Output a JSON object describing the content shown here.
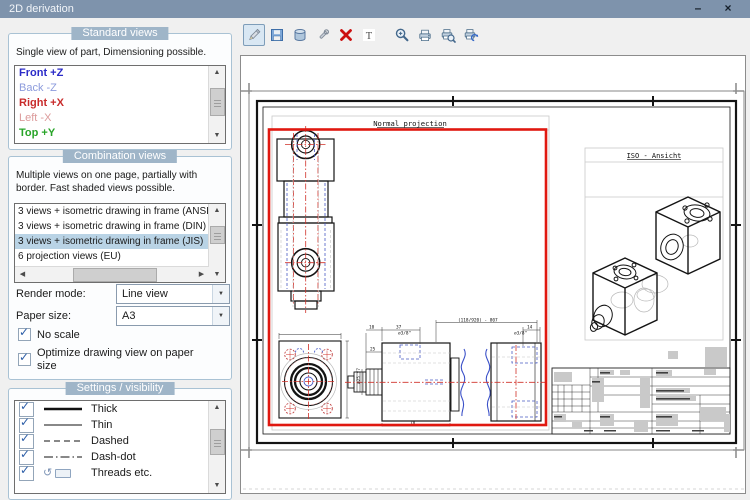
{
  "window": {
    "title": "2D derivation"
  },
  "icons": {
    "minimize": "–",
    "close": "×",
    "dropdown": "▼",
    "scroll_up": "▲",
    "scroll_down": "▼",
    "scroll_left": "◀",
    "scroll_right": "▶",
    "check": "✓",
    "threads_arrow": "↺",
    "text_tool_glyph": "T"
  },
  "toolbar": {
    "buttons": [
      {
        "id": "edit",
        "icon": "pencil-icon",
        "active": true
      },
      {
        "id": "save",
        "icon": "save-icon",
        "active": false
      },
      {
        "id": "database",
        "icon": "database-icon",
        "active": false
      },
      {
        "id": "modify",
        "icon": "wrench-icon",
        "active": false
      },
      {
        "id": "delete",
        "icon": "delete-x-icon",
        "active": false
      },
      {
        "id": "text",
        "icon": "text-icon",
        "active": false
      },
      {
        "id": "zoom",
        "icon": "magnifier-icon",
        "active": false
      },
      {
        "id": "print",
        "icon": "printer-icon",
        "active": false
      },
      {
        "id": "print-preview",
        "icon": "printer-preview-icon",
        "active": false
      },
      {
        "id": "print-setup",
        "icon": "printer-setup-icon",
        "active": false
      }
    ]
  },
  "standard_views": {
    "header": "Standard views",
    "description": "Single view of part, Dimensioning possible.",
    "items": [
      {
        "label": "Front +Z",
        "color": "#2B2BC8",
        "bold": true
      },
      {
        "label": "Back -Z",
        "color": "#8C9BDC",
        "bold": false
      },
      {
        "label": "Right +X",
        "color": "#C82B2B",
        "bold": true
      },
      {
        "label": "Left -X",
        "color": "#DC9B9B",
        "bold": false
      },
      {
        "label": "Top +Y",
        "color": "#28A428",
        "bold": true
      }
    ]
  },
  "combination_views": {
    "header": "Combination views",
    "description": "Multiple views on one page, partially with border. Fast shaded views possible.",
    "items": [
      "3 views + isometric drawing in frame (ANSI)",
      "3 views + isometric drawing in frame (DIN)",
      "3 views + isometric drawing in frame (JIS)",
      "6 projection views (EU)"
    ],
    "selected_index": 2
  },
  "options": {
    "render_mode_label": "Render mode:",
    "render_mode_value": "Line view",
    "paper_size_label": "Paper size:",
    "paper_size_value": "A3",
    "no_scale_label": "No scale",
    "no_scale_checked": true,
    "optimize_label": "Optimize drawing view on paper size",
    "optimize_checked": true
  },
  "settings_visibility": {
    "header": "Settings / visibility",
    "items": [
      {
        "label": "Thick",
        "checked": true,
        "swatch": "thick-line"
      },
      {
        "label": "Thin",
        "checked": true,
        "swatch": "thin-line"
      },
      {
        "label": "Dashed",
        "checked": true,
        "swatch": "dashed-line"
      },
      {
        "label": "Dash-dot",
        "checked": true,
        "swatch": "dashdot-line"
      },
      {
        "label": "Threads etc.",
        "checked": true,
        "swatch": "threads-icons"
      }
    ]
  },
  "preview": {
    "normal_projection_label": "Normal projection",
    "iso_view_label": "ISO - Ansicht",
    "dim_labels": {
      "d10": "10",
      "d37": "37",
      "d25": "25",
      "d78": "78",
      "d14": "14",
      "shaft": "⌀25 f7",
      "thread_left": "⌀3/8\"",
      "thread_right": "⌀3/8\"",
      "overall": "(118/920) - 807"
    },
    "colors": {
      "selection_red": "#E01810",
      "centerline_red": "#D03028",
      "hidden_blue": "#4A5BC4",
      "badge_blue": "#9FB5C8",
      "titlebar_blue": "#7E93AC"
    }
  }
}
